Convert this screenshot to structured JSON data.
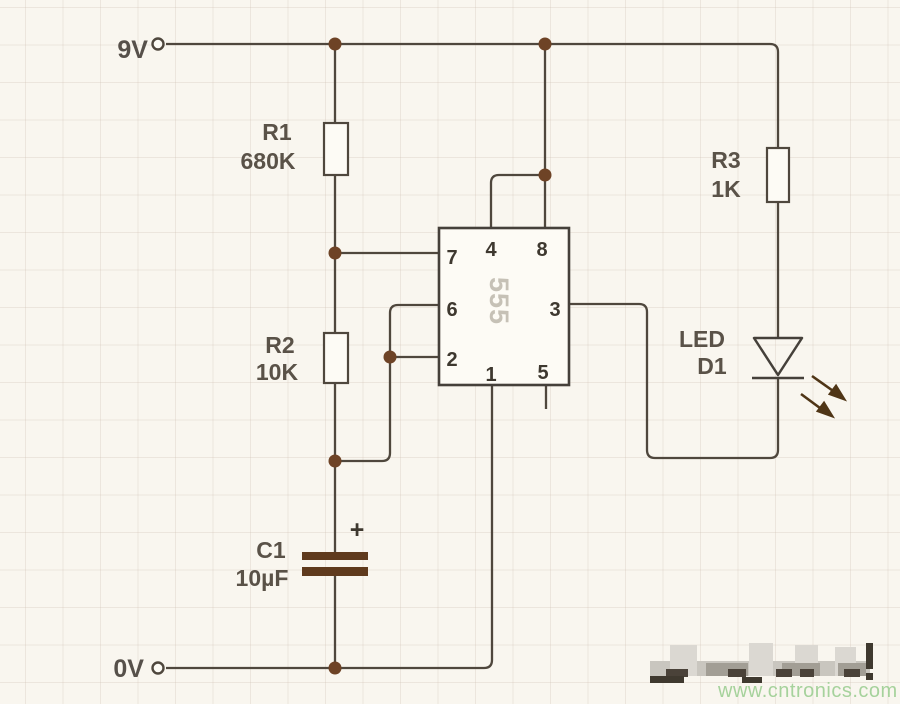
{
  "circuit": {
    "supply_rail_label": "9V",
    "ground_rail_label": "0V",
    "r1": {
      "ref": "R1",
      "value": "680K"
    },
    "r2": {
      "ref": "R2",
      "value": "10K"
    },
    "r3": {
      "ref": "R3",
      "value": "1K"
    },
    "c1": {
      "ref": "C1",
      "value": "10µF",
      "polarity_mark": "+"
    },
    "ic555": {
      "part_label": "555",
      "pins": {
        "p1": "1",
        "p2": "2",
        "p3": "3",
        "p4": "4",
        "p5": "5",
        "p6": "6",
        "p7": "7",
        "p8": "8"
      }
    },
    "led": {
      "label": "LED",
      "ref": "D1"
    }
  },
  "watermark": {
    "url_text": "www.cntronics.com",
    "color": "#a6d29c"
  },
  "palette": {
    "wire": "#4f473d",
    "junction_dot": "#6e4326",
    "background": "#f9f6ef",
    "grid_line": "#e7dfd4",
    "component_fill": "#fdfbf5",
    "ic_silkscreen": "#c6c1b6",
    "capacitor_plate": "#5f3a1d",
    "led_arrow": "#4f3516"
  }
}
